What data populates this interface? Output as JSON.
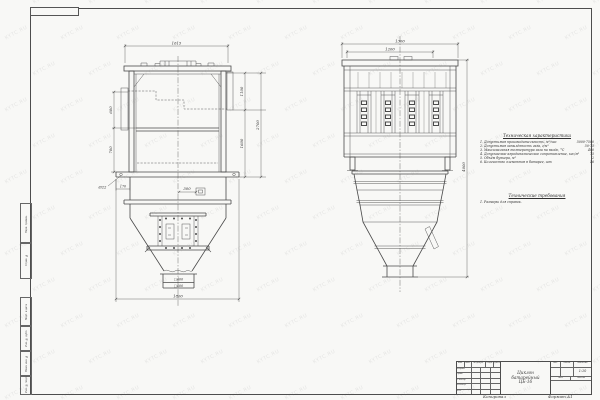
{
  "watermark": {
    "text": "KYTC.RU"
  },
  "sheet": {
    "margin_stamps": [
      {
        "label": "Перв. примен."
      },
      {
        "label": "Справ. №"
      },
      {
        "label": "Подп. и дата"
      },
      {
        "label": "Инв. № дубл."
      },
      {
        "label": "Взам. инв. №"
      },
      {
        "label": "Инв. № подл."
      }
    ]
  },
  "left_view": {
    "dims": {
      "top_width": "1615",
      "left_upper": "600",
      "left_lower": "700",
      "bolt_hole": "Ø22",
      "base_offset": "170",
      "fitting_offset": "300",
      "right_upper": "1100",
      "right_lower": "1600",
      "right_overall": "2700",
      "outlet_inner": "□400",
      "outlet_outer": "□600",
      "bottom_width": "1800"
    }
  },
  "right_view": {
    "dims": {
      "top_outer": "1300",
      "top_inner": "1200",
      "overall_height": "4000"
    }
  },
  "notes": {
    "heading": "Техническая характеристика",
    "items": [
      {
        "label": "1. Допустимая производительность, м³/час",
        "value": "5000-7500"
      },
      {
        "label": "2. Допустимая запылённость газа, г/м³",
        "value": "50-75"
      },
      {
        "label": "3. Максимальная температура газа на входе, °С",
        "value": "400"
      },
      {
        "label": "4. Допускаемое аэродинамическое сопротивление, кгс/м²",
        "value": "75"
      },
      {
        "label": "5. Объём бункера, м³",
        "value": "2"
      },
      {
        "label": "6. Количество элементов в батарее, шт",
        "value": "16"
      }
    ],
    "requirements_heading": "Технические требования",
    "requirements_item": "1. Размеры для справок."
  },
  "title_block": {
    "header": [
      "Изм.",
      "Лист",
      "№ докум.",
      "Подп.",
      "Дата"
    ],
    "rows": [
      "Разраб.",
      "Пров.",
      "Т.контр.",
      "Н.контр.",
      "Утв."
    ],
    "name": [
      "Циклон",
      "батарейный",
      "ЦБ-16"
    ],
    "right_header": [
      "Лит.",
      "Масса",
      "Масштаб"
    ],
    "scale": "1:10",
    "sheet_labels": [
      "Лист",
      "Листов"
    ],
    "footer_copy": "Копировал",
    "footer_format": "Формат А1"
  }
}
